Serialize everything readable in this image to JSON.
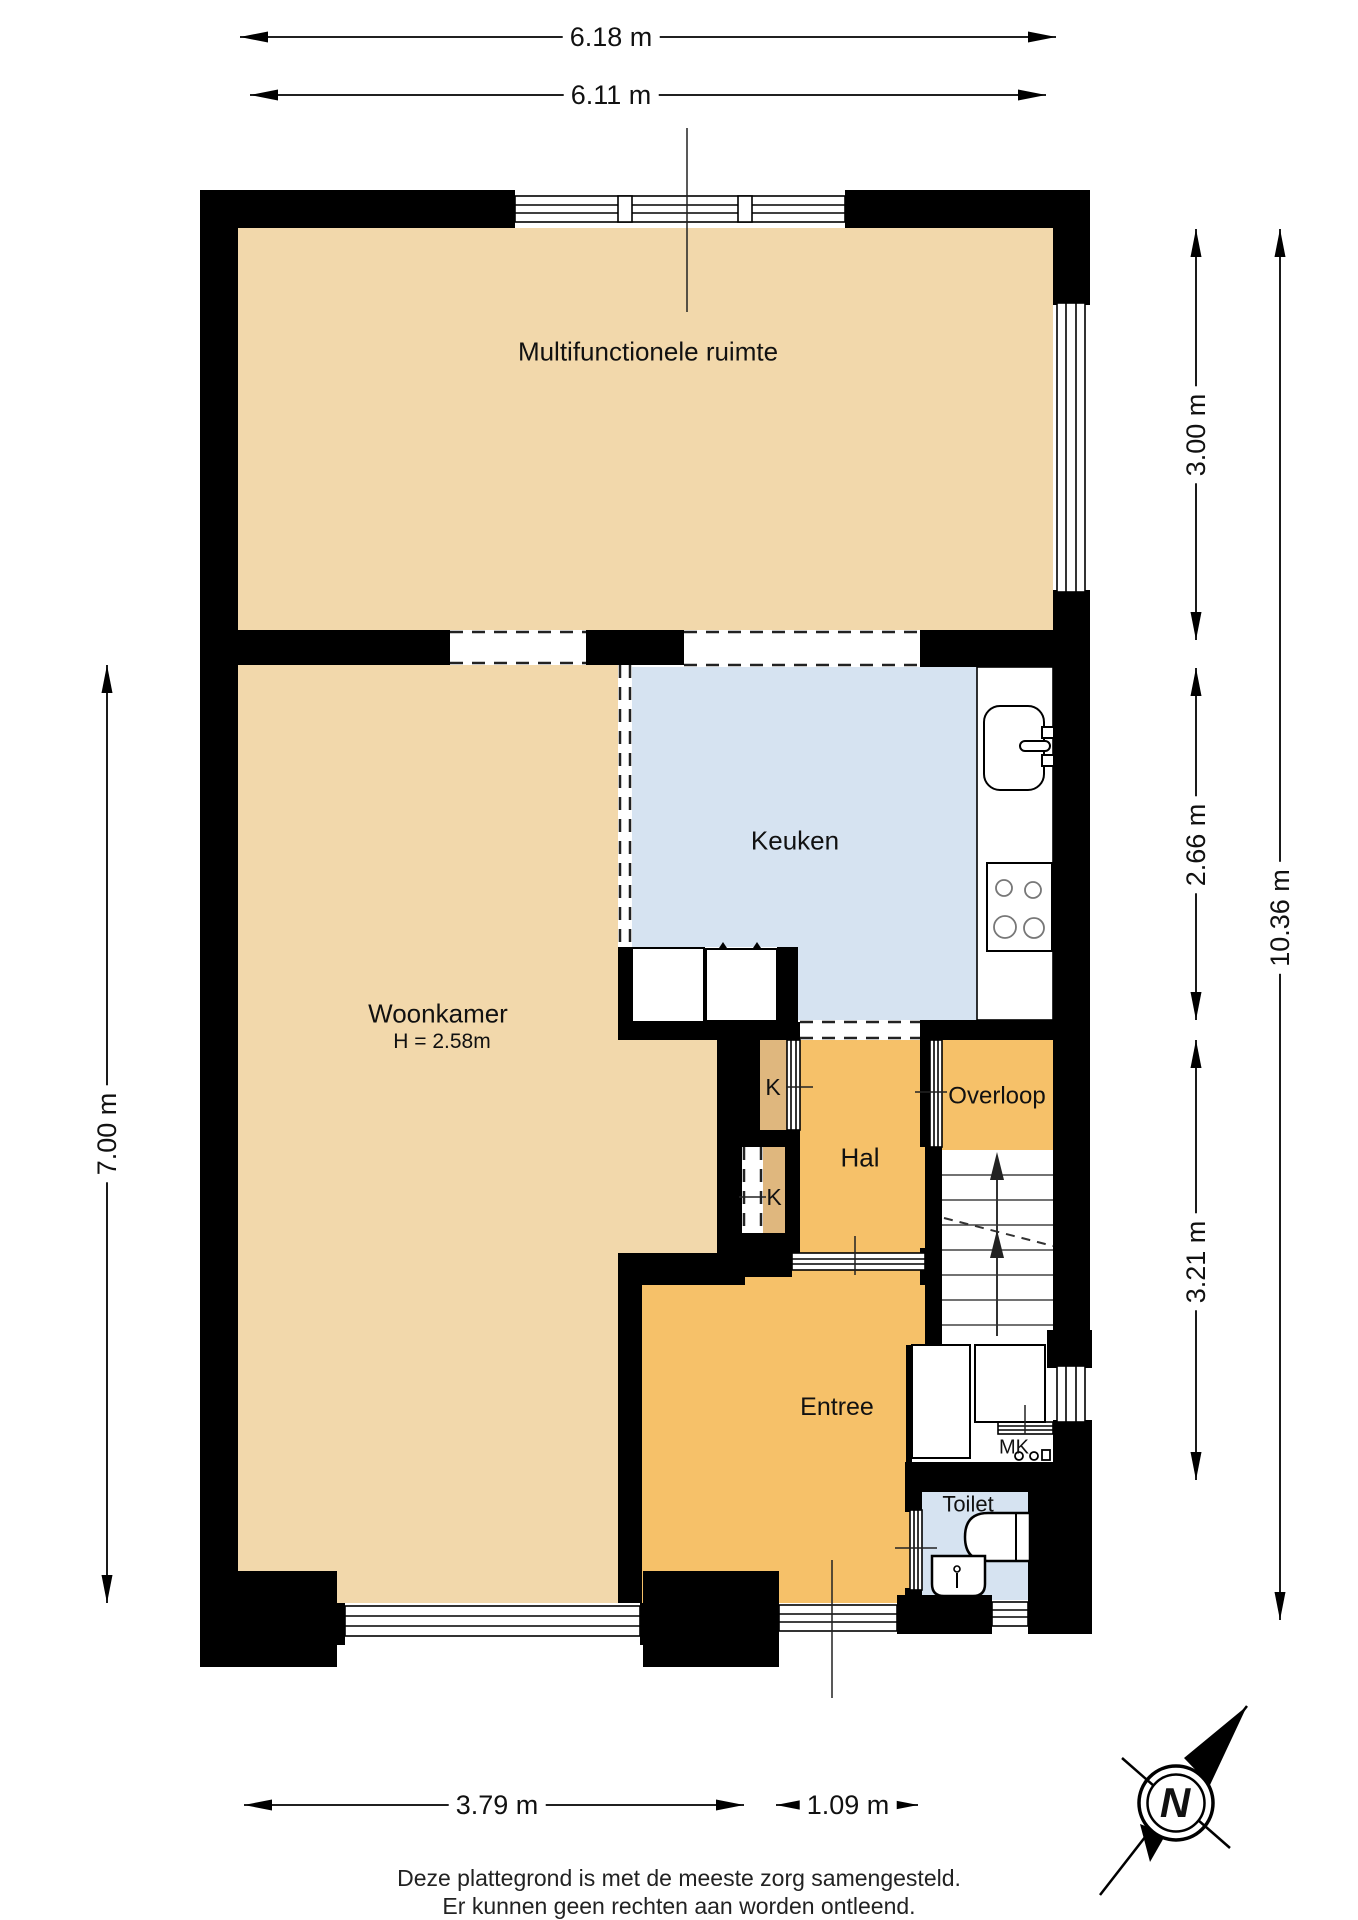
{
  "title": "floor-plan",
  "rooms": [
    {
      "id": "multifunctionele-ruimte",
      "label": "Multifunctionele ruimte"
    },
    {
      "id": "woonkamer",
      "label": "Woonkamer",
      "sublabel": "H = 2.58m"
    },
    {
      "id": "keuken",
      "label": "Keuken"
    },
    {
      "id": "hal",
      "label": "Hal"
    },
    {
      "id": "overloop",
      "label": "Overloop"
    },
    {
      "id": "entree",
      "label": "Entree"
    },
    {
      "id": "toilet",
      "label": "Toilet"
    },
    {
      "id": "kast-boven",
      "label": "K"
    },
    {
      "id": "kast-onder",
      "label": "K"
    },
    {
      "id": "meterkast",
      "label": "MK"
    }
  ],
  "dimensions": {
    "top_outer": "6.18 m",
    "top_inner": "6.11 m",
    "right_upper": "3.00 m",
    "right_middle": "2.66 m",
    "right_lower": "3.21 m",
    "right_total": "10.36 m",
    "left": "7.00 m",
    "bottom_left": "3.79 m",
    "bottom_right": "1.09 m"
  },
  "compass": {
    "label": "N"
  },
  "footer": {
    "line1": "Deze plattegrond is met de meeste zorg samengesteld.",
    "line2": "Er kunnen geen rechten aan worden ontleend."
  },
  "fixtures": {
    "kitchen": [
      "sink-with-faucet",
      "cooktop-four-burners",
      "appliance",
      "appliance"
    ],
    "toilet": [
      "toilet-bowl",
      "hand-basin"
    ],
    "stairs": "staircase-going-up",
    "meterkast": "utility-meters"
  },
  "colors": {
    "floor_tan": "#f2d8ab",
    "floor_orange": "#f6c169",
    "floor_blue": "#d6e3f1",
    "closet_tan": "#dfb77e",
    "wall": "#000000",
    "line": "#1a1a1a"
  }
}
